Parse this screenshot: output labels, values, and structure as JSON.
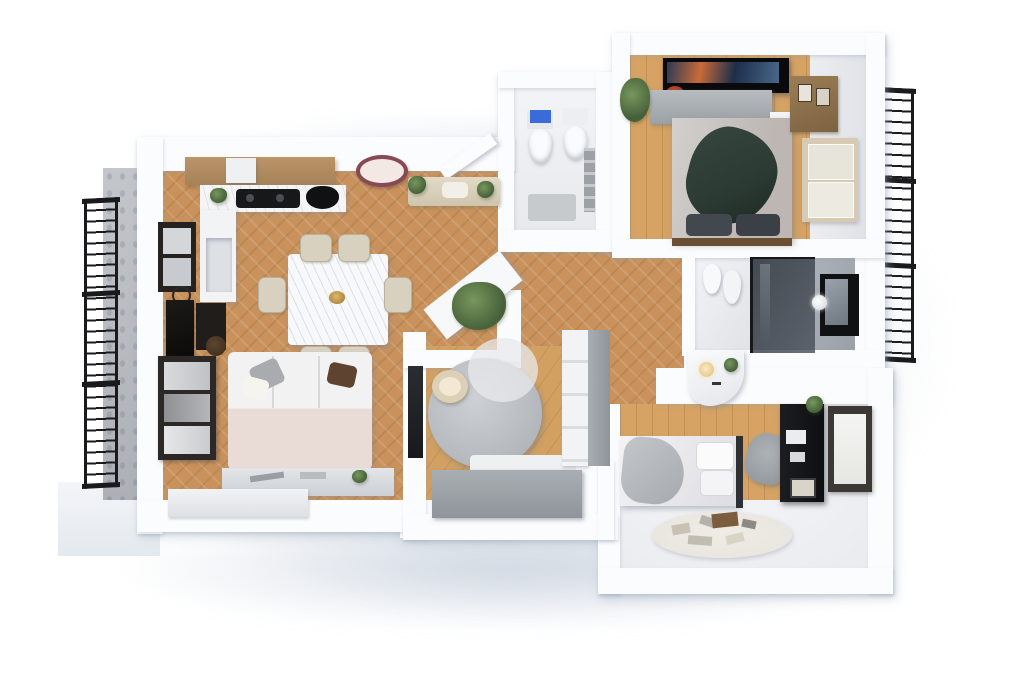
{
  "title": "3D apartment floor plan (top-down render)",
  "palette": {
    "wall": "#fbfcfd",
    "wall_shade": "#e2e7ee",
    "wood": "#c9925c",
    "wood_light": "#d6a364",
    "wood_plank2": "#d2a162",
    "white_floor": "#e9ebef",
    "gray_floor": "#9aa0a8",
    "railing": "#1a1a1d",
    "stone": "#b8bbc1",
    "cream": "#d9d1bf",
    "sofa_pink": "#e9dcd7",
    "gray_furniture": "#aeb3b8",
    "blanket_green": "#2c3a34",
    "lamp_rim": "#874953",
    "shower_glass": "#3f444c",
    "cistern_blue": "#3a6bd8",
    "plant": "#46603a",
    "desk_black": "#17181a",
    "frame_dark": "#262420",
    "rug": "#e9e6df"
  },
  "rooms": [
    {
      "id": "living-dining-kitchen",
      "floor": "herringbone-oak",
      "furniture": [
        "kitchen-upper-cabinets",
        "range-hood",
        "cooktop",
        "kitchen-sink",
        "marble-counter",
        "counter-niche",
        "dining-table",
        "dining-chair x6",
        "pendant-lamp",
        "entry-bench-with-plants",
        "sofa",
        "sofa-cushions",
        "console-behind-sofa",
        "low-sideboard",
        "tv-media-wall",
        "wall-console",
        "wall-art",
        "stool",
        "window-left",
        "plants"
      ]
    },
    {
      "id": "wc",
      "floor": "white-tile",
      "furniture": [
        "toilet",
        "bidet",
        "blue-cistern",
        "wall-shelf",
        "bath-mat"
      ]
    },
    {
      "id": "master-bedroom",
      "floor": "oak-planks",
      "furniture": [
        "wall-tv",
        "dresser",
        "double-bed",
        "green-blanket",
        "dark-pillows",
        "foot-bench",
        "corner-plant",
        "red-flowers",
        "wall-shelf",
        "window-right",
        "ac-unit"
      ]
    },
    {
      "id": "bathroom",
      "floor": "white-and-gray-tile",
      "furniture": [
        "toilet",
        "bidet",
        "walk-in-shower-smoked-glass",
        "vanity-with-lamp",
        "vanity-plant",
        "wall-picture",
        "round-mirror"
      ]
    },
    {
      "id": "lounge-entrance",
      "floor": "oak-planks",
      "furniture": [
        "round-daybed",
        "round-cushion",
        "corner-bench",
        "bench-cushions",
        "wardrobe",
        "wall-niche",
        "ledge-plant"
      ]
    },
    {
      "id": "hallway",
      "floor": "herringbone-oak",
      "furniture": [
        "tall-gray-cabinet",
        "curved-vanity-counter"
      ]
    },
    {
      "id": "second-bedroom",
      "floor": "oak-planks-and-white",
      "furniture": [
        "single-bed",
        "gray-blanket",
        "pillows",
        "desk-black",
        "desk-chair",
        "desk-plant",
        "window-right",
        "play-rug-with-toys"
      ]
    },
    {
      "id": "exterior",
      "furniture": [
        "left-balcony-railing",
        "right-balcony-railing",
        "stone-facade-strip",
        "balcony-slab"
      ]
    }
  ]
}
